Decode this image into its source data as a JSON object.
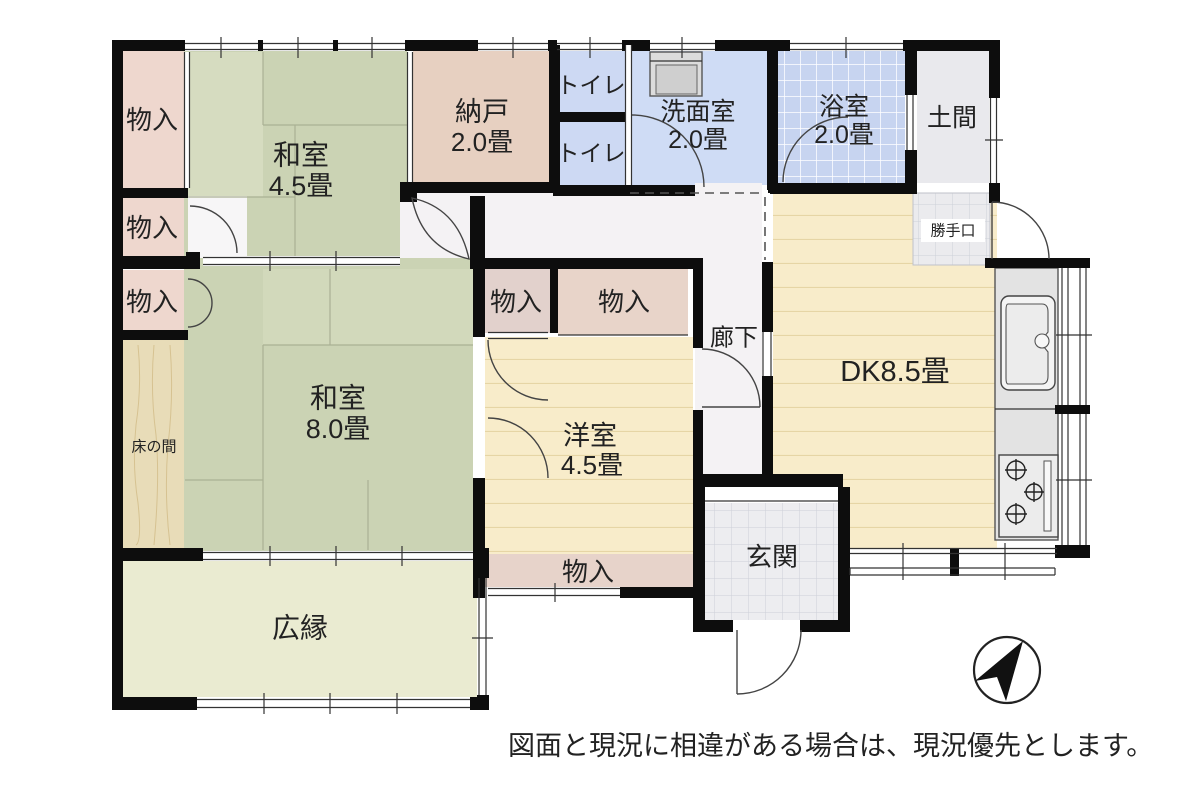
{
  "plan": {
    "rooms": {
      "washitsu45": {
        "name": "和室",
        "size": "4.5畳"
      },
      "washitsu8": {
        "name": "和室",
        "size": "8.0畳"
      },
      "nando": {
        "name": "納戸",
        "size": "2.0畳"
      },
      "senmen": {
        "name": "洗面室",
        "size": "2.0畳"
      },
      "yokushitsu": {
        "name": "浴室",
        "size": "2.0畳"
      },
      "youshitsu": {
        "name": "洋室",
        "size": "4.5畳"
      },
      "dk": {
        "name": "DK8.5畳"
      },
      "toilet": {
        "name": "トイレ"
      },
      "doma": {
        "name": "土間"
      },
      "katteguchi": {
        "name": "勝手口"
      },
      "rouka": {
        "name": "廊下"
      },
      "genkan": {
        "name": "玄関"
      },
      "hiroen": {
        "name": "広縁"
      },
      "tokonoma": {
        "name": "床の間"
      },
      "monoire": {
        "name": "物入"
      }
    },
    "footnote": "図面と現況に相違がある場合は、現況優先とします。",
    "colors": {
      "wall": "#0d0d0d",
      "tatami_green": "#cbd3b4",
      "closet_pink": "#eed7ce",
      "nando_tan": "#e7d0c1",
      "water_blue": "#cfdcf5",
      "bath_blue": "#c7d4f0",
      "wood_cream": "#f8ecca",
      "veranda": "#eaebd1",
      "tokonoma_wood": "#e8dcb8",
      "tile_gray": "#ededf0",
      "corridor": "#f4f2f4"
    }
  }
}
